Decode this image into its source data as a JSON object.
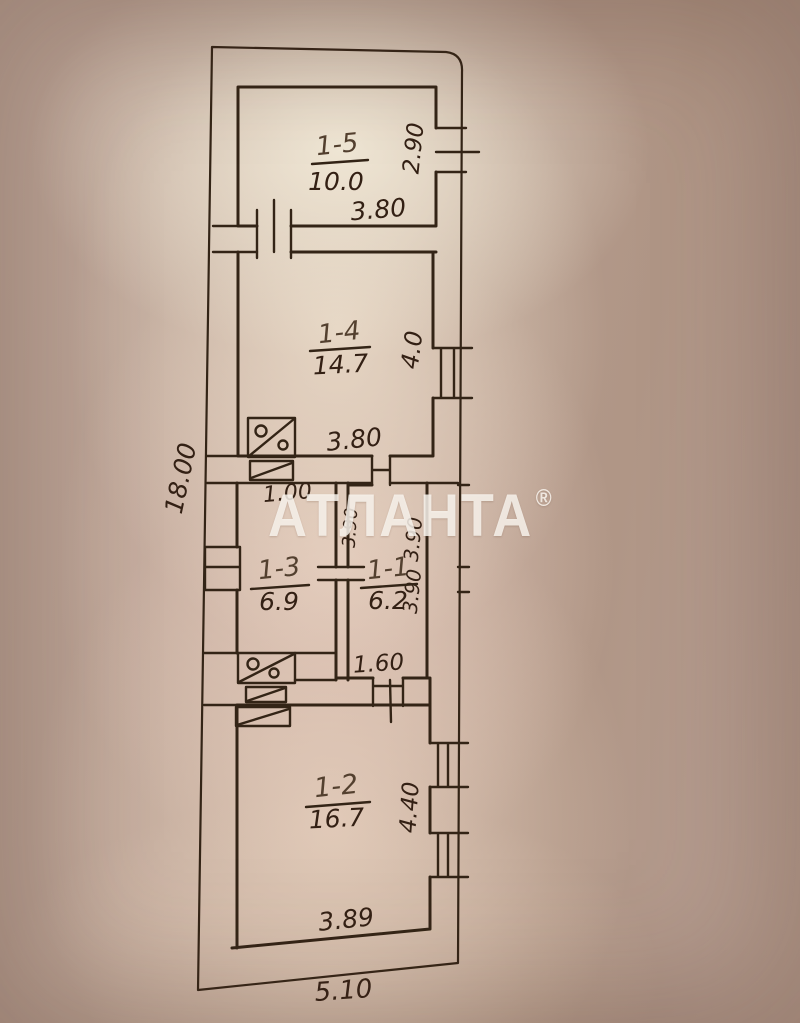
{
  "watermark": {
    "text": "АТЛАНТА",
    "registered": "®"
  },
  "colors": {
    "paper_base": "#b59c8e",
    "paper_light": "#f3ebd9",
    "ink": "#332416",
    "watermark": "rgba(251,248,242,0.82)"
  },
  "rooms": [
    {
      "label": "1-5",
      "area": "10.0"
    },
    {
      "label": "1-4",
      "area": "14.7"
    },
    {
      "label": "1-3",
      "area": "6.9"
    },
    {
      "label": "1-1",
      "area": "6.2"
    },
    {
      "label": "1-2",
      "area": "16.7"
    }
  ],
  "dimensions": {
    "overall_height": "18.00",
    "overall_width": "5.10",
    "room5_width": "3.80",
    "room5_window": "2.90",
    "room4_width": "3.80",
    "room4_window": "4.0",
    "hall_passage": "1.00",
    "depth_a": "3.90",
    "depth_b": "3.90",
    "depth_c": "3.90",
    "door_width": "1.60",
    "room2_window": "4.40",
    "room2_width": "3.89"
  },
  "symbols": {
    "stove": "stove-icon",
    "flue": "flue-hatch-icon",
    "window": "window-symbol",
    "door": "door-opening"
  }
}
